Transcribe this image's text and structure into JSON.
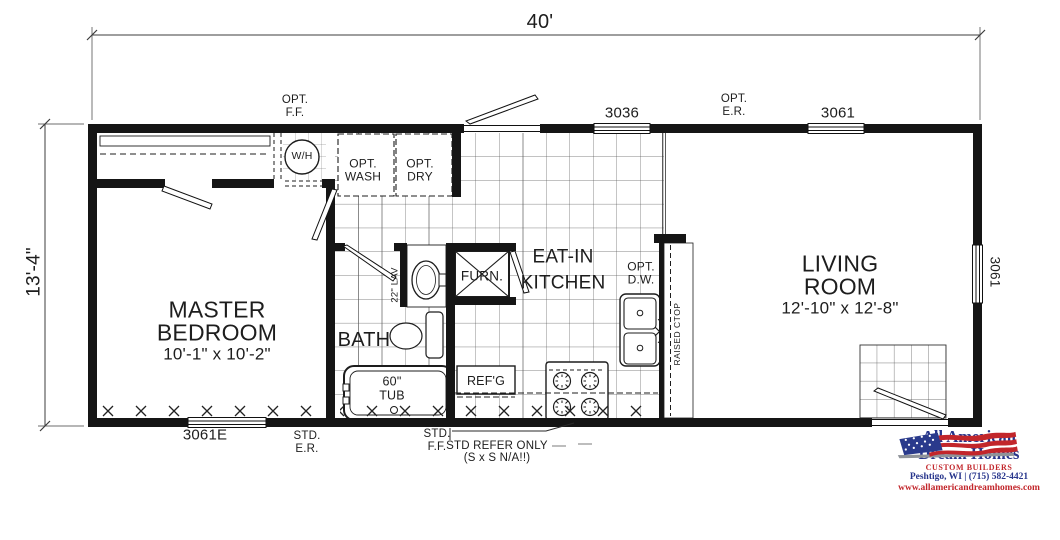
{
  "dimensions": {
    "width": "40'",
    "depth": "13'-4\""
  },
  "rooms": {
    "master_name": "MASTER\nBEDROOM",
    "master_size": "10'-1\" x 10'-2\"",
    "living_name": "LIVING\nROOM",
    "living_size": "12'-10\" x 12'-8\"",
    "kitchen_name": "EAT-IN\nKITCHEN",
    "bath_name": "BATH"
  },
  "fixtures": {
    "water_heater": "W/H",
    "opt_washer": "OPT.\nWASH",
    "opt_dryer": "OPT.\nDRY",
    "furnace": "FURN.",
    "opt_dishwasher": "OPT.\nD.W.",
    "raised_counter": "RAISED CTOP",
    "lavatory": "22\" LAV",
    "tub": "60\"\nTUB",
    "refrigerator": "REF'G"
  },
  "windows": {
    "top_kitchen": "3036",
    "top_living": "3061",
    "right_living": "3061",
    "bottom_bedroom": "3061E"
  },
  "notes": {
    "opt_ff": "OPT.\nF.F.",
    "opt_er": "OPT.\nE.R.",
    "std_er": "STD.\nE.R.",
    "std_ff": "STD.\nF.F.",
    "std_refer": "STD REFER ONLY\n(S x S N/A!!)"
  },
  "logo": {
    "name_line1": "All American",
    "name_line2": "Dream Homes",
    "tagline": "CUSTOM BUILDERS",
    "contact": "Peshtigo, WI | (715) 582-4421",
    "website": "www.allamericandreamhomes.com"
  },
  "colors": {
    "line": "#1d1d1d",
    "logo_navy": "#27358c",
    "logo_red": "#c2262b"
  }
}
